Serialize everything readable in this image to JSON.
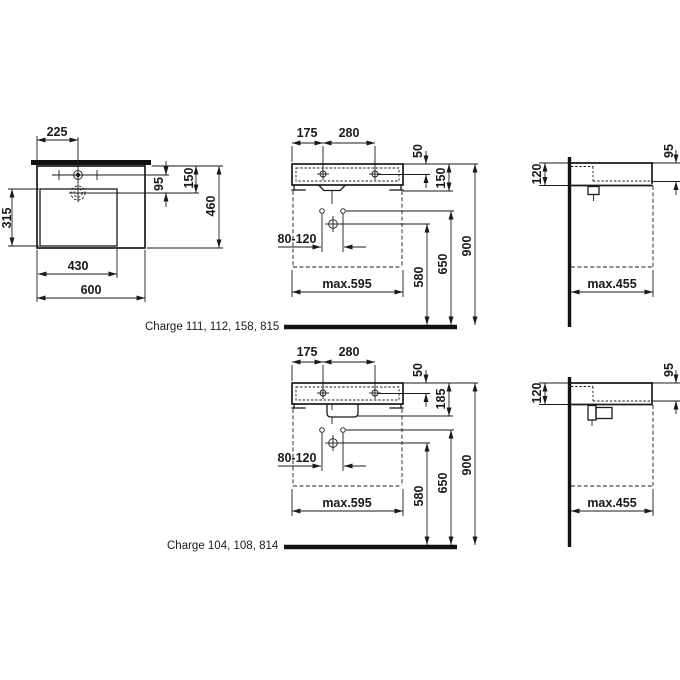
{
  "colors": {
    "line": "#1a1a1a",
    "heavy": "#111111",
    "background": "#ffffff"
  },
  "plan": {
    "tap_offset": "225",
    "basin_depth": "315",
    "basin_width": "430",
    "total_width": "600",
    "drain_to_tap": "95",
    "drain_depth": "150",
    "total_depth": "460"
  },
  "front_a": {
    "tap_left": "175",
    "tap_span": "280",
    "tap_drop": "50",
    "apron_height": "150",
    "fixing_span": "80-120",
    "max_width": "max.595",
    "drain_height": "580",
    "fixing_height": "650",
    "rim_height": "900"
  },
  "side_a": {
    "wall_height": "120",
    "front_height": "95",
    "max_depth": "max.455"
  },
  "front_b": {
    "tap_left": "175",
    "tap_span": "280",
    "tap_drop": "50",
    "apron_height": "185",
    "fixing_span": "80-120",
    "max_width": "max.595",
    "drain_height": "580",
    "fixing_height": "650",
    "rim_height": "900"
  },
  "side_b": {
    "wall_height": "120",
    "front_height": "95",
    "max_depth": "max.455"
  },
  "captions": {
    "variant_a": "Charge 111, 112, 158, 815",
    "variant_b": "Charge 104, 108, 814"
  }
}
